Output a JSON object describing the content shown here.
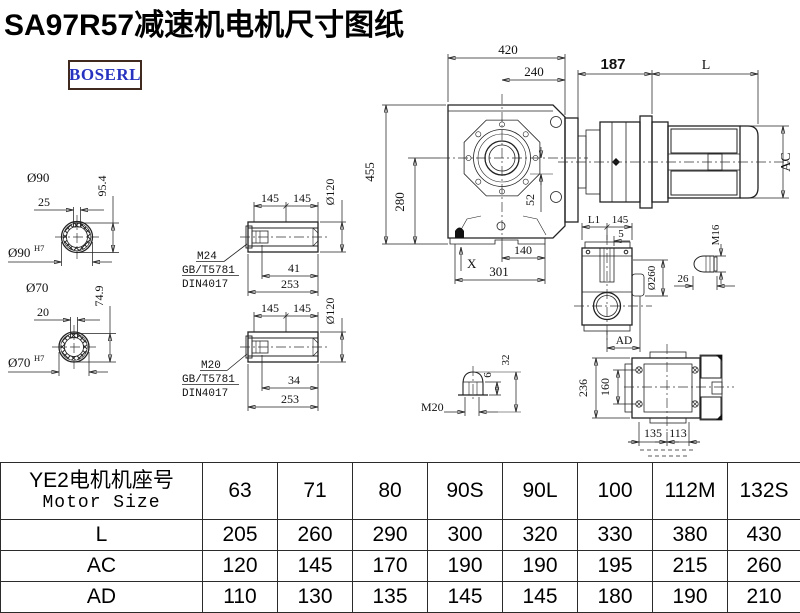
{
  "title": "SA97R57减速机电机尺寸图纸",
  "logo": "BOSERL",
  "colors": {
    "title": "#000000",
    "line": "#222222",
    "logo_text": "#2733c0",
    "logo_border": "#40291f"
  },
  "drawing": {
    "front": {
      "w420": "420",
      "w240": "240",
      "h455": "455",
      "h280": "280",
      "d52": "52",
      "x_mark": "X",
      "b140": "140",
      "b301": "301"
    },
    "motor": {
      "d187": "187",
      "L": "L",
      "AC": "AC"
    },
    "shaft90": {
      "dia": "Ø90",
      "key": "25",
      "h": "95.4",
      "fit": "Ø90",
      "fit_sup": "H7"
    },
    "shaft70": {
      "dia": "Ø70",
      "key": "20",
      "h": "74.9",
      "fit": "Ø70",
      "fit_sup": "H7"
    },
    "sleeve_top": {
      "a": "145",
      "b": "145",
      "dia": "Ø120",
      "thread": "M24",
      "std1": "GB/T5781",
      "std2": "DIN4017",
      "len1": "41",
      "len2": "253"
    },
    "sleeve_bottom": {
      "a": "145",
      "b": "145",
      "dia": "Ø120",
      "thread": "M20",
      "std1": "GB/T5781",
      "std2": "DIN4017",
      "len1": "34",
      "len2": "253"
    },
    "side": {
      "L1": "L1",
      "d145": "145",
      "d5": "5",
      "dia260": "Ø260",
      "AD": "AD",
      "M16": "M16",
      "d26": "26"
    },
    "plug": {
      "M20": "M20",
      "d6": "6",
      "d32": "32"
    },
    "rear": {
      "d236": "236",
      "d160": "160",
      "d135": "135",
      "d113": "113"
    }
  },
  "table": {
    "header_cn": "YE2电机机座号",
    "header_en": "Motor Size",
    "sizes": [
      "63",
      "71",
      "80",
      "90S",
      "90L",
      "100",
      "112M",
      "132S"
    ],
    "rows": [
      {
        "label": "L",
        "values": [
          "205",
          "260",
          "290",
          "300",
          "320",
          "330",
          "380",
          "430"
        ]
      },
      {
        "label": "AC",
        "values": [
          "120",
          "145",
          "170",
          "190",
          "190",
          "195",
          "215",
          "260"
        ]
      },
      {
        "label": "AD",
        "values": [
          "110",
          "130",
          "135",
          "145",
          "145",
          "180",
          "190",
          "210"
        ]
      }
    ]
  }
}
